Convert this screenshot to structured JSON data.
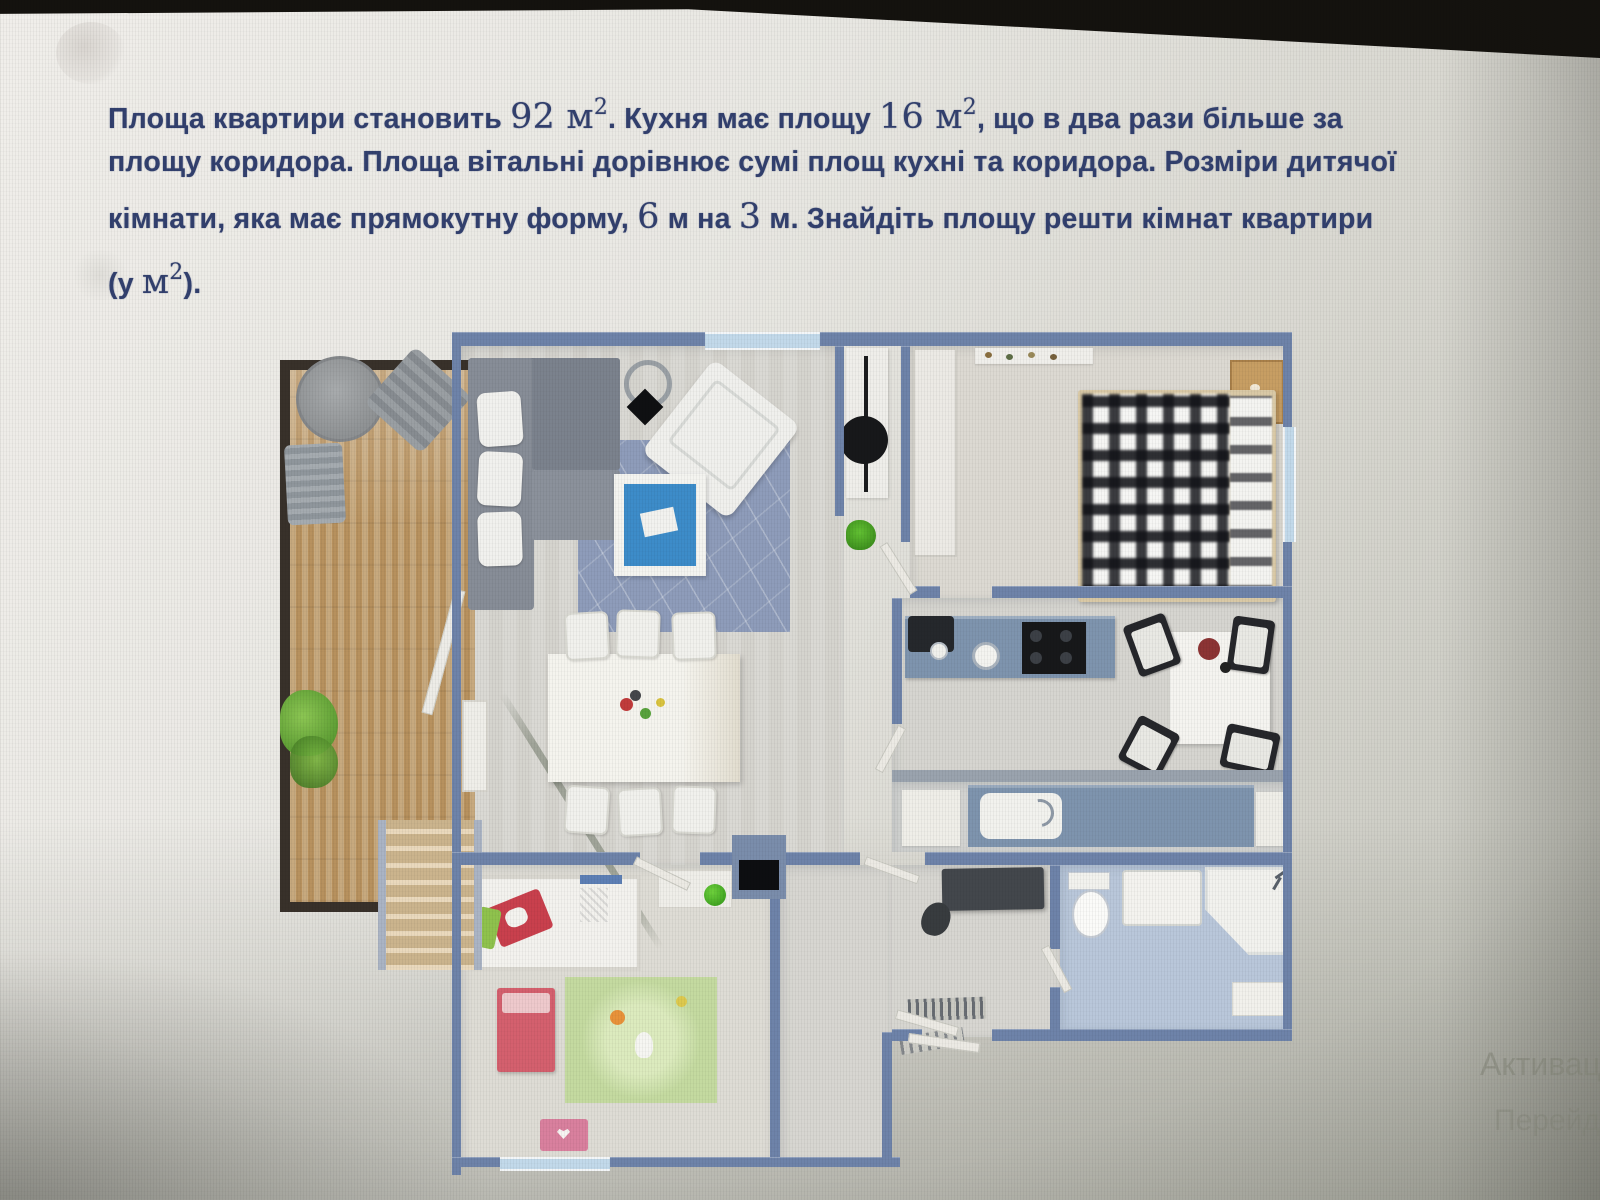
{
  "problem": {
    "lines": [
      [
        {
          "t": "Площа квартири становить ",
          "s": "plain"
        },
        {
          "t": "92 м",
          "s": "serif"
        },
        {
          "t": "2",
          "s": "serifsup"
        },
        {
          "t": ". Кухня має площу ",
          "s": "plain"
        },
        {
          "t": "16 м",
          "s": "serif"
        },
        {
          "t": "2",
          "s": "serifsup"
        },
        {
          "t": ", що в два рази більше за",
          "s": "plain"
        }
      ],
      [
        {
          "t": "площу коридора. Площа вітальні дорівнює сумі площ кухні та коридора. Розміри дитячої",
          "s": "plain"
        }
      ],
      [
        {
          "t": "кімнати, яка має прямокутну форму, ",
          "s": "plain"
        },
        {
          "t": "6",
          "s": "serif"
        },
        {
          "t": " м на ",
          "s": "plain"
        },
        {
          "t": "3",
          "s": "serif"
        },
        {
          "t": " м. Знайдіть площу решти кімнат квартири",
          "s": "plain"
        }
      ],
      [
        {
          "t": "(у ",
          "s": "plain"
        },
        {
          "t": "м",
          "s": "serif"
        },
        {
          "t": "2",
          "s": "serifsup"
        },
        {
          "t": ").",
          "s": "plain"
        }
      ]
    ]
  },
  "watermark": {
    "line1": "Активаці",
    "line2": "Перейд"
  },
  "floorplan": {
    "description": "3D top-down apartment plan",
    "rooms": [
      "balcony-terrace",
      "living-dining-room",
      "workspace-nook",
      "bedroom",
      "kitchen",
      "vanity-strip",
      "corridor-hall",
      "bathroom",
      "children-room",
      "staircase"
    ]
  },
  "colors": {
    "text-blue": "#32406e",
    "watermark": "#8b8d80",
    "wall": "#6e83a9",
    "wall-light": "#9aa3ae",
    "window": "#c2d9ea",
    "balcony-wall": "#38312a",
    "deck-a": "#c7a97e",
    "deck-b": "#b7915e",
    "floor-living": "#dad9d4",
    "floor-bedroom": "#dcd9d2",
    "floor-kitchen": "#d6d5d0",
    "floor-hall": "#d7d6d1",
    "floor-children": "#dedcd5",
    "floor-bath": "#b9c7da",
    "sofa": "#878d97",
    "sofa-dark": "#747b86",
    "cushion": "#f1f1ee",
    "rug": "#8e9cba",
    "table-top": "#3d8cc9",
    "counter": "#7e94ae",
    "bed-frame": "#d9c9a6",
    "rug-green": "#c4daa0",
    "bed-red": "#d4606e",
    "toy-pink": "#d9809e"
  }
}
